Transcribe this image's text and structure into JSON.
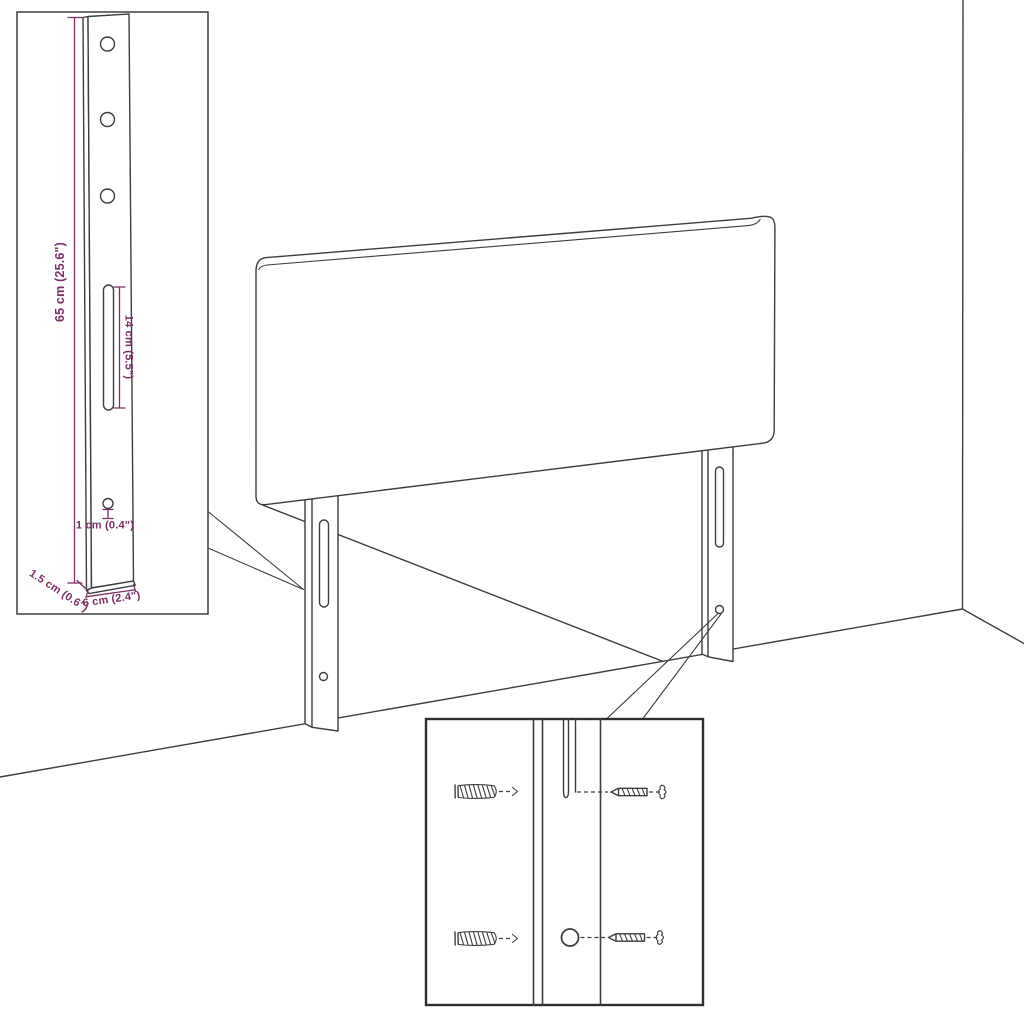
{
  "figure": {
    "title": "Headboard wall-mounting dimension diagram",
    "colors": {
      "background": "#ffffff",
      "line": "#3d3d3d",
      "dimension_accent": "#7b2f66"
    },
    "leg_detail_inset": {
      "dimensions": {
        "height": "65 cm (25.6\")",
        "slot_length": "14 cm (5.5\")",
        "hole_diameter": "1 cm (0.4\")",
        "thickness": "1.5 cm (0.6\")",
        "width": "6 cm (2.4\")"
      }
    },
    "mounting_inset": {
      "hardware_icons": [
        "wall-plug-icon",
        "wall-plug-icon",
        "screw-icon",
        "screw-icon"
      ]
    }
  }
}
